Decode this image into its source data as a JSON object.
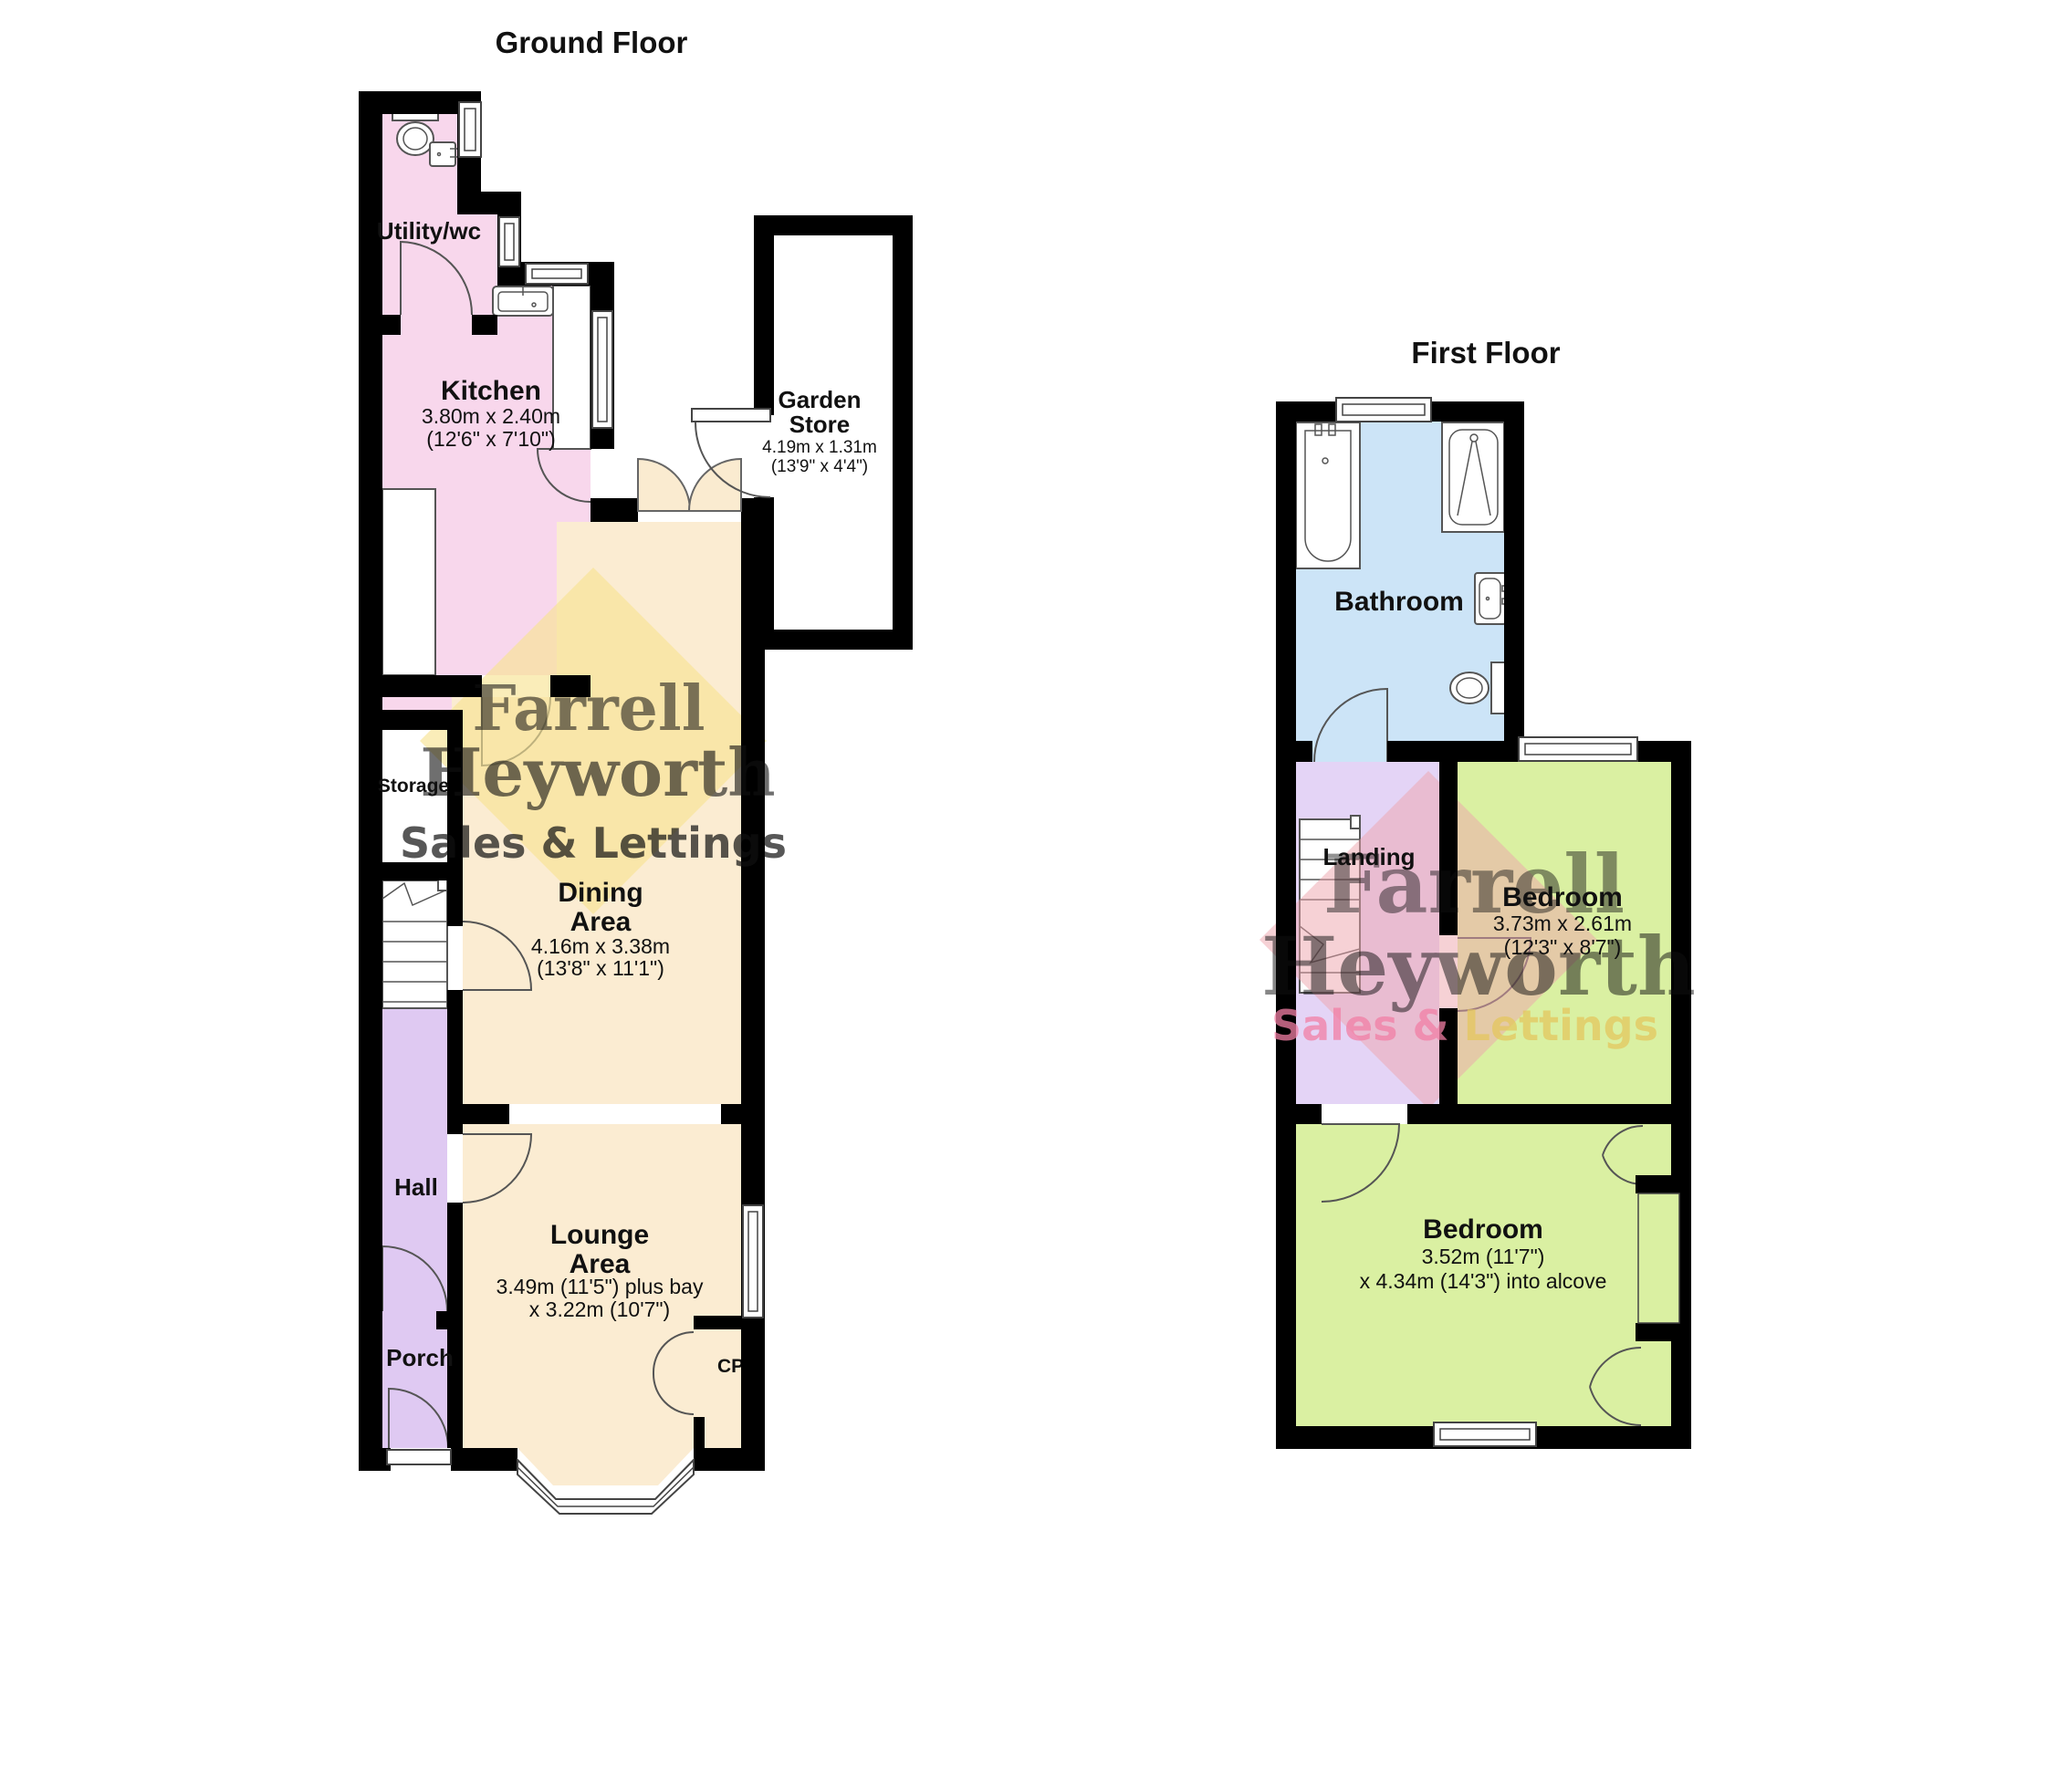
{
  "ground_floor": {
    "title": "Ground Floor",
    "utility": {
      "label": "Utility/wc"
    },
    "kitchen": {
      "label": "Kitchen",
      "dims_m": "3.80m x 2.40m",
      "dims_ft": "(12'6\" x 7'10\")"
    },
    "garden_store": {
      "label_line1": "Garden",
      "label_line2": "Store",
      "dims_m": "4.19m x 1.31m",
      "dims_ft": "(13'9\" x 4'4\")"
    },
    "storage": {
      "label": "Storage"
    },
    "dining": {
      "label_line1": "Dining",
      "label_line2": "Area",
      "dims_m": "4.16m x 3.38m",
      "dims_ft": "(13'8\" x 11'1\")"
    },
    "hall": {
      "label": "Hall"
    },
    "porch": {
      "label": "Porch"
    },
    "lounge": {
      "label_line1": "Lounge",
      "label_line2": "Area",
      "dims_line1": "3.49m (11'5\") plus bay",
      "dims_line2": "x 3.22m (10'7\")"
    },
    "cupboard": {
      "label": "CPD"
    }
  },
  "first_floor": {
    "title": "First Floor",
    "bathroom": {
      "label": "Bathroom"
    },
    "landing": {
      "label": "Landing"
    },
    "bedroom1": {
      "label": "Bedroom",
      "dims_m": "3.73m x 2.61m",
      "dims_ft": "(12'3\" x 8'7\")"
    },
    "bedroom2": {
      "label": "Bedroom",
      "dims_line1": "3.52m (11'7\")",
      "dims_line2": "x 4.34m (14'3\") into alcove"
    }
  },
  "watermark": {
    "name_line1": "Farrell",
    "name_line2": "Heyworth",
    "tagline": "Sales & Lettings",
    "tagline_part1": "Sales &",
    "tagline_part2": " Lettings"
  },
  "colors": {
    "wall": "#000000",
    "utility_kitchen_pink": "#F8D7EC",
    "dining_lounge_cream": "#FBECD2",
    "hall_purple": "#DFC9F2",
    "landing_purple": "#E4D4F6",
    "bathroom_blue": "#CCE4F7",
    "bedroom_green": "#DAF0A2",
    "watermark_yellow": "#F7E494",
    "watermark_pink": "#EDA3AC",
    "watermark_name1": "#8F87A8",
    "watermark_name2": "#9FB0C6",
    "watermark_tagline": "#F27FA5",
    "watermark_tagline_alt": "#E4C75E"
  }
}
